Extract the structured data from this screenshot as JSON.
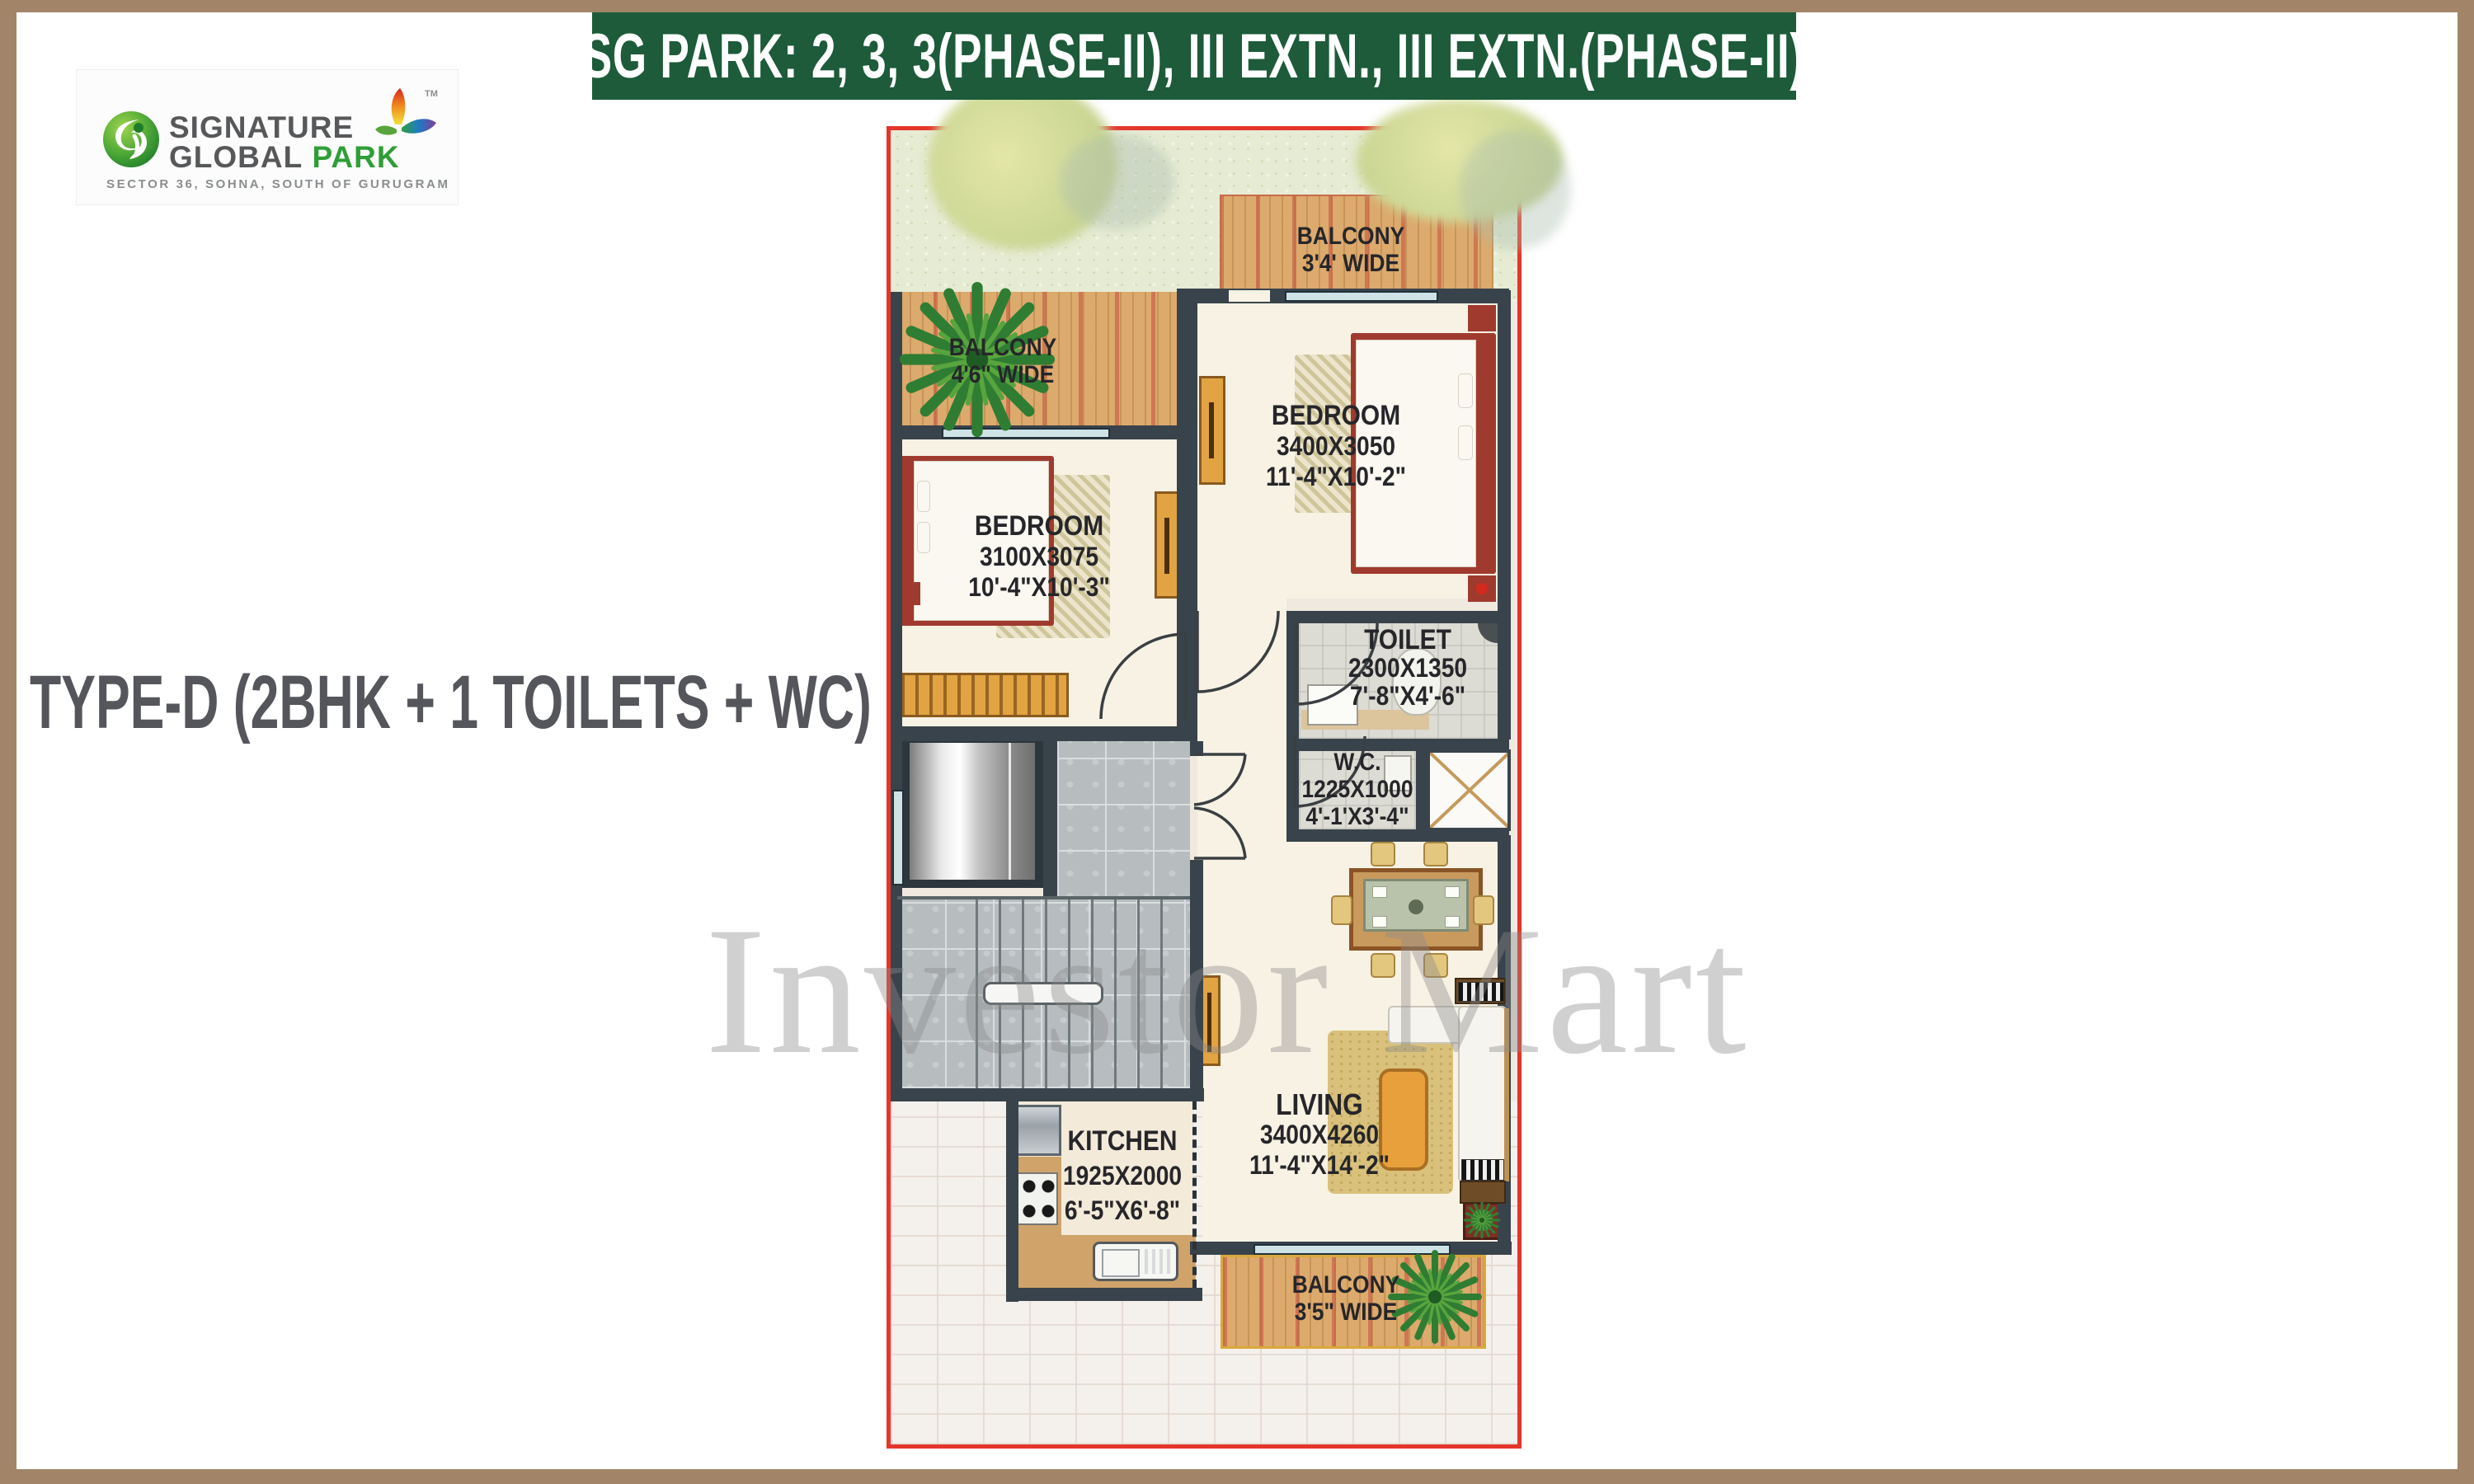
{
  "banner": {
    "text": "SG PARK: 2, 3, 3(PHASE-II), III EXTN., III EXTN.(PHASE-II)",
    "bg": "#1d5b3a"
  },
  "brand": {
    "line1": "SIGNATURE",
    "line2": "GLOBAL",
    "line2_accent": "PARK",
    "tm": "TM",
    "tagline": "SECTOR 36, SOHNA, SOUTH OF GURUGRAM"
  },
  "type_label": {
    "text": "TYPE-D (2BHK + 1 TOILETS + WC)"
  },
  "watermark": {
    "text": "Investor Mart"
  },
  "rooms": {
    "balcony_top": {
      "lines": [
        "BALCONY",
        "3'4' WIDE"
      ]
    },
    "balcony_left": {
      "lines": [
        "BALCONY",
        "4'6\" WIDE"
      ]
    },
    "balcony_bottom": {
      "lines": [
        "BALCONY",
        "3'5\" WIDE"
      ]
    },
    "bedroom_right": {
      "lines": [
        "BEDROOM",
        "3400X3050",
        "11'-4\"X10'-2\""
      ]
    },
    "bedroom_left": {
      "lines": [
        "BEDROOM",
        "3100X3075",
        "10'-4\"X10'-3\""
      ]
    },
    "toilet": {
      "lines": [
        "TOILET",
        "2300X1350",
        "7'-8\"X4'-6\""
      ]
    },
    "wc": {
      "lines": [
        "W.C.",
        "1225X1000",
        "4'-1'X3'-4\""
      ]
    },
    "kitchen": {
      "lines": [
        "KITCHEN",
        "1925X2000",
        "6'-5\"X6'-8\""
      ]
    },
    "living": {
      "lines": [
        "LIVING",
        "3400X4260",
        "11'-4\"X14'-2\""
      ]
    }
  },
  "colors": {
    "frame_brown": "#a28569",
    "banner_green": "#1d5b3a",
    "plan_border_red": "#e5352b",
    "wall": "#39434b",
    "wood_balcony": "#dcaa6d",
    "lawn_green": "#e6ebd3",
    "stair_tile_gray": "#b7bcbf",
    "floor_cream": "#f8f2e4",
    "furniture_orange": "#e2a342",
    "bed_red": "#a03a2f",
    "logo_green": "#2f9e37",
    "title_gray": "#55565c",
    "watermark_gray": "#8b8b8b"
  }
}
